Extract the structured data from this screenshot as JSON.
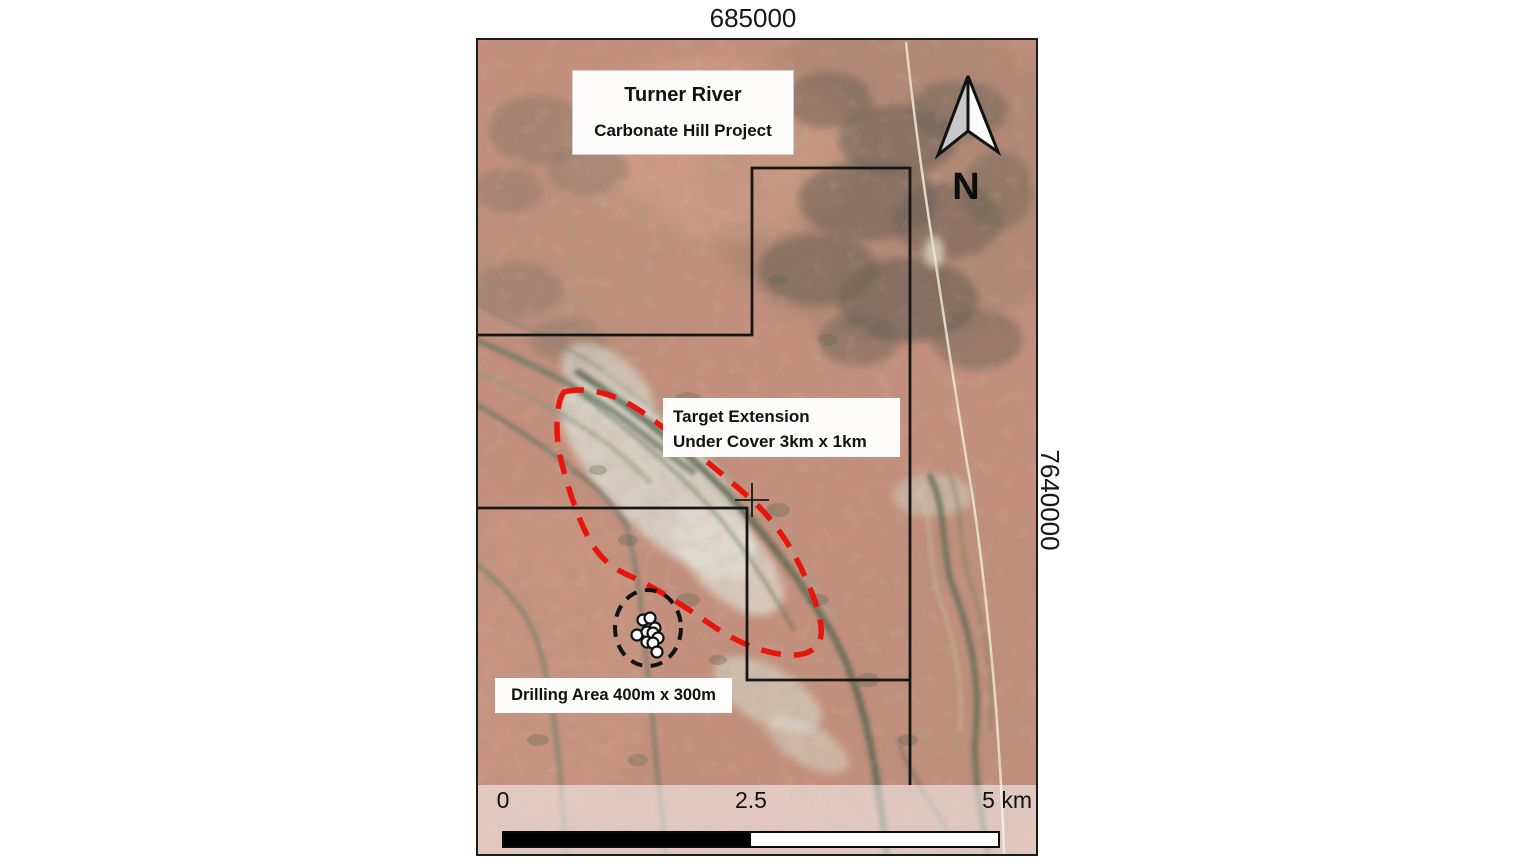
{
  "map": {
    "grid_labels": {
      "top": "685000",
      "right": "7640000"
    },
    "title_box": {
      "line1": "Turner River",
      "line2": "Carbonate Hill Project"
    },
    "target_label": {
      "line1": "Target Extension",
      "line2": "Under Cover 3km x 1km"
    },
    "drilling_label": "Drilling Area 400m x 300m",
    "north_label": "N",
    "scale_bar": {
      "tick_start": "0",
      "tick_mid": "2.5",
      "tick_end": "5 km"
    },
    "colors": {
      "target_ellipse_outline": "#e8150c",
      "tenement_boundary": "#161616",
      "drill_area_circle": "#111111",
      "drill_dot_fill": "#ffffff",
      "scale_black": "#000000",
      "scale_white": "#ffffff",
      "terrain_base": "#c4907e"
    },
    "drill_holes": {
      "radius": 5.5,
      "points": [
        [
          165,
          580
        ],
        [
          172,
          578
        ],
        [
          177,
          588
        ],
        [
          159,
          595
        ],
        [
          169,
          592
        ],
        [
          175,
          593
        ],
        [
          180,
          598
        ],
        [
          169,
          602
        ],
        [
          175,
          603
        ],
        [
          179,
          612
        ]
      ]
    }
  }
}
